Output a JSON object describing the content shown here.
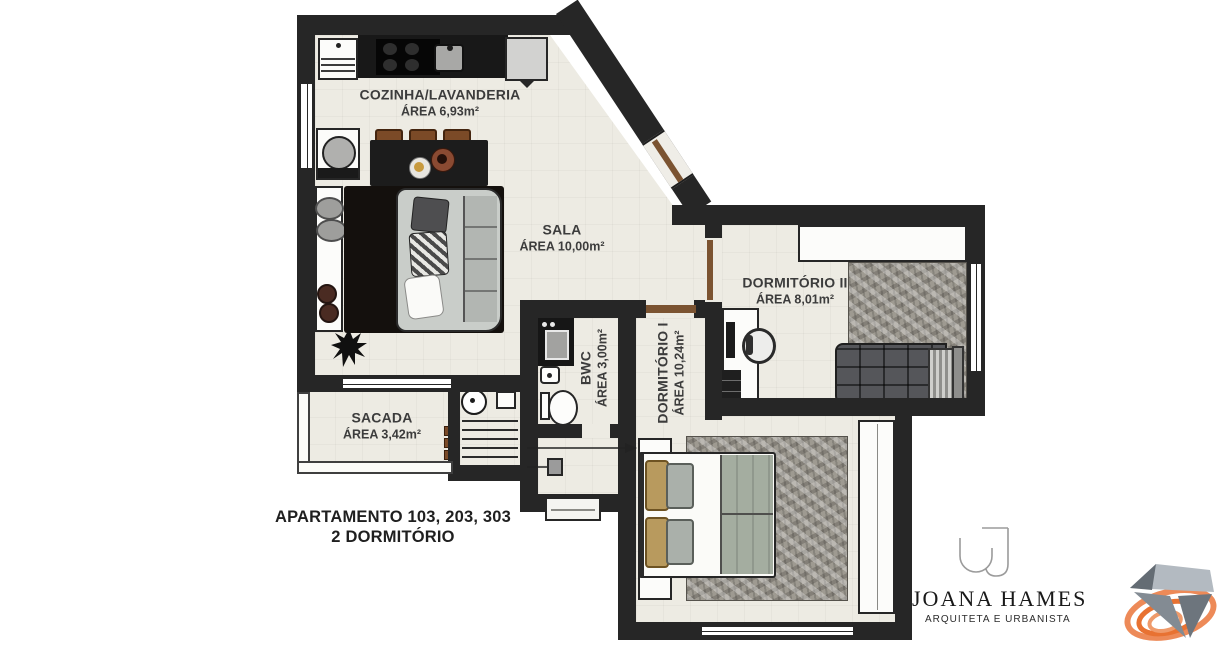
{
  "plan": {
    "rooms": [
      {
        "name": "COZINHA/LAVANDERIA",
        "area": "ÁREA 6,93m²"
      },
      {
        "name": "SALA",
        "area": "ÁREA 10,00m²"
      },
      {
        "name": "DORMITÓRIO II",
        "area": "ÁREA 8,01m²"
      },
      {
        "name": "BWC",
        "area": "ÁREA 3,00m²"
      },
      {
        "name": "DORMITÓRIO I",
        "area": "ÁREA 10,24m²"
      },
      {
        "name": "SACADA",
        "area": "ÁREA 3,42m²"
      }
    ],
    "caption_line1": "APARTAMENTO 103, 203, 303",
    "caption_line2": "2 DORMITÓRIO"
  },
  "brand": {
    "name": "JOANA HAMES",
    "tagline": "ARQUITETA E URBANISTA"
  },
  "icons": {
    "monogram": "j-monogram",
    "gem": "diamond-gem-with-orange-swirl",
    "plant": "potted-plant"
  },
  "colors": {
    "wall": "#262626",
    "floor": "#edebe3",
    "accent_orange": "#e87232",
    "label": "#3c3c3c",
    "door_wood": "#7b5331"
  }
}
